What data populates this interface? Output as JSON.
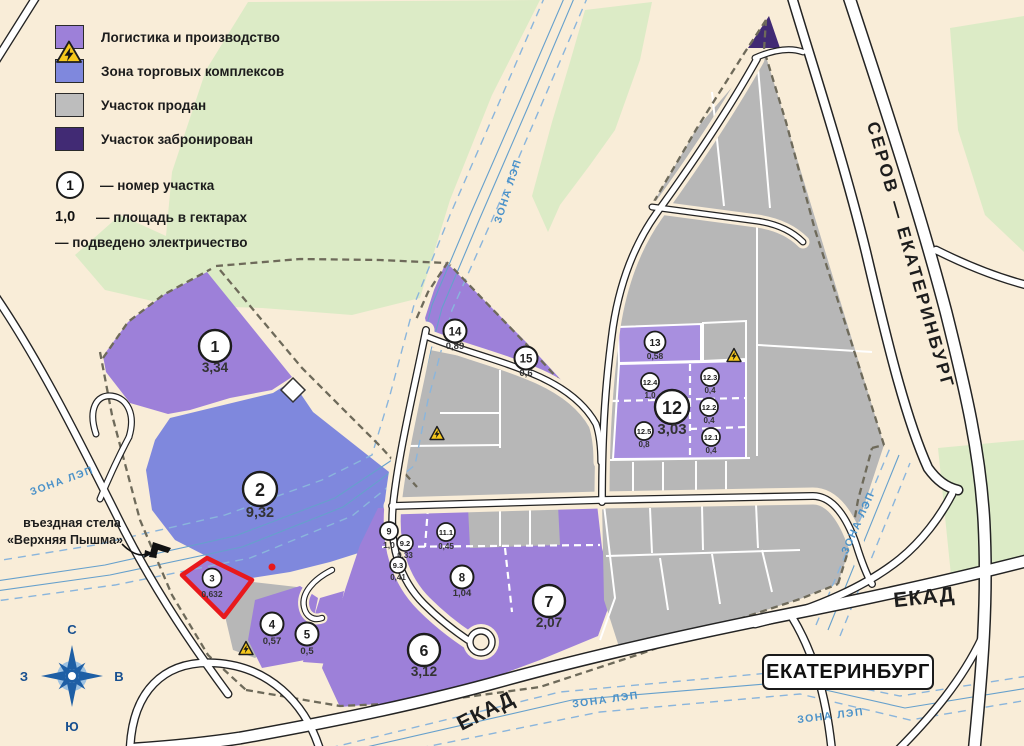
{
  "legend": {
    "items": [
      {
        "id": "logistics",
        "label": "Логистика и производство",
        "color": "#9d80d9"
      },
      {
        "id": "trade",
        "label": "Зона торговых комплексов",
        "color": "#7f88dd"
      },
      {
        "id": "sold",
        "label": "Участок продан",
        "color": "#bdbdbd"
      },
      {
        "id": "reserved",
        "label": "Участок забронирован",
        "color": "#412a74"
      }
    ],
    "number_symbol": "1",
    "number_label": "— номер участка",
    "area_symbol": "1,0",
    "area_label": "— площадь в гектарах",
    "electricity_label": "— подведено электричество"
  },
  "plots": [
    {
      "number": "1",
      "area": "3,34"
    },
    {
      "number": "2",
      "area": "9,32"
    },
    {
      "number": "3",
      "area": "0,632"
    },
    {
      "number": "4",
      "area": "0,57"
    },
    {
      "number": "5",
      "area": "0,5"
    },
    {
      "number": "6",
      "area": "3,12"
    },
    {
      "number": "7",
      "area": "2,07"
    },
    {
      "number": "8",
      "area": "1,04"
    },
    {
      "number": "9",
      "area": "1,0"
    },
    {
      "number": "9.2",
      "area": "0,33"
    },
    {
      "number": "9.3",
      "area": "0,41"
    },
    {
      "number": "11.1",
      "area": "0,45"
    },
    {
      "number": "12",
      "area": "3,03"
    },
    {
      "number": "12.1",
      "area": "0,4"
    },
    {
      "number": "12.2",
      "area": "0,4"
    },
    {
      "number": "12.3",
      "area": "0,4"
    },
    {
      "number": "12.4",
      "area": "1,0"
    },
    {
      "number": "12.5",
      "area": "0,8"
    },
    {
      "number": "13",
      "area": "0,58"
    },
    {
      "number": "14",
      "area": "0,89"
    },
    {
      "number": "15",
      "area": "0,6"
    }
  ],
  "map_labels": {
    "highway": "СЕРОВ — ЕКАТЕРИНБУРГ",
    "ekad": "ЕКАД",
    "city_sign": "ЕКАТЕРИНБУРГ",
    "power_zone": "ЗОНА ЛЭП",
    "stela_line1": "въездная стела",
    "stela_line2": "«Верхняя Пышма»"
  },
  "compass": {
    "north": "С",
    "south": "Ю",
    "west": "З",
    "east": "В"
  },
  "colors": {
    "logistics": "#9d80d9",
    "trade": "#7f88dd",
    "sold": "#bdbdbd",
    "reserved": "#412a74",
    "highlight": "#e8191c",
    "power_line": "#4b92c9"
  }
}
